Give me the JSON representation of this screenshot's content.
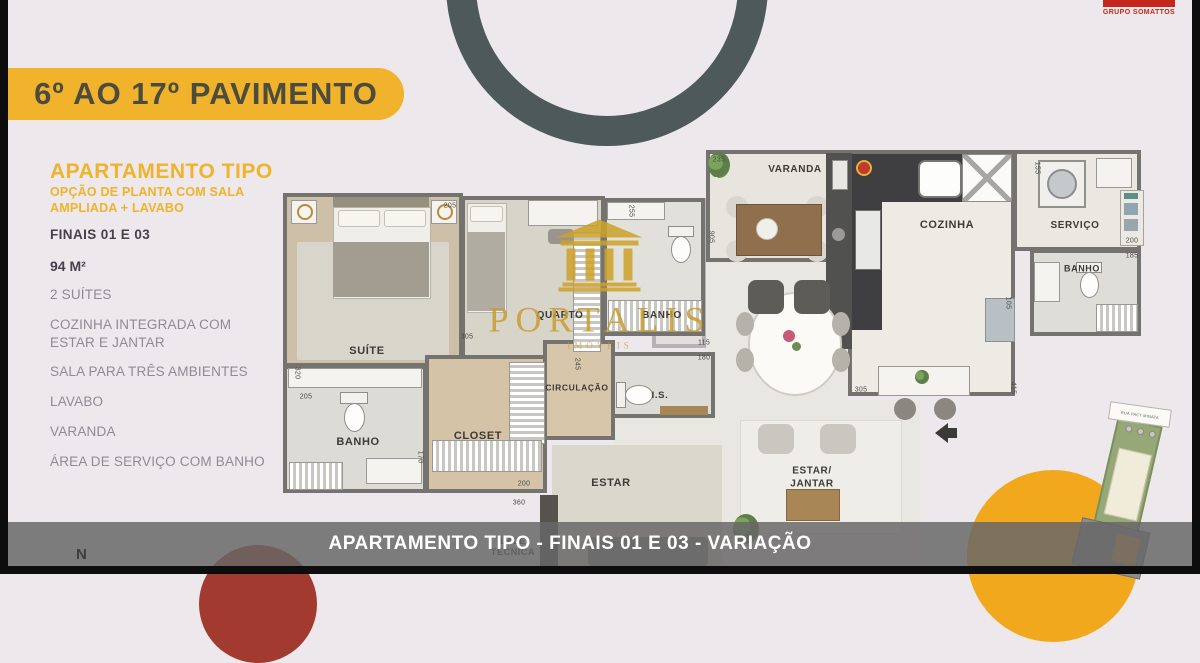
{
  "palette": {
    "accent_yellow": "#F0B32B",
    "slate_ring": "#4D5A59",
    "brand_red": "#C4281C",
    "circle_red": "#A23A2F",
    "circle_yellow": "#F2A81D",
    "gold": "#C99C2E"
  },
  "banner": {
    "title": "6º AO 17º PAVIMENTO"
  },
  "brand_top": {
    "name": "GRUPO SOMATTOS"
  },
  "sidebar": {
    "title": "APARTAMENTO TIPO",
    "subtitle": "OPÇÃO DE PLANTA COM SALA\nAMPLIADA + LAVABO",
    "finais": "FINAIS 01 E 03",
    "area": "94 M²",
    "features": [
      "2 SUÍTES",
      "COZINHA INTEGRADA COM ESTAR E JANTAR",
      "SALA PARA TRÊS AMBIENTES",
      "LAVABO",
      "VARANDA",
      "ÁREA DE SERVIÇO COM BANHO"
    ]
  },
  "watermark": {
    "name": "PORTALIS",
    "tagline": "IMÓVEIS"
  },
  "floorplan": {
    "rooms": [
      {
        "t": "VARANDA",
        "x": 795,
        "y": 170,
        "fs": 10
      },
      {
        "t": "COZINHA",
        "x": 947,
        "y": 226,
        "fs": 11
      },
      {
        "t": "SERVIÇO",
        "x": 1075,
        "y": 226,
        "fs": 10
      },
      {
        "t": "BANHO",
        "x": 1082,
        "y": 269,
        "fs": 9
      },
      {
        "t": "SUÍTE",
        "x": 367,
        "y": 352,
        "fs": 11
      },
      {
        "t": "QUARTO",
        "x": 560,
        "y": 316,
        "fs": 10
      },
      {
        "t": "BANHO",
        "x": 662,
        "y": 316,
        "fs": 10
      },
      {
        "t": "CIRCULAÇÃO",
        "x": 577,
        "y": 388,
        "fs": 8.5
      },
      {
        "t": "I.S.",
        "x": 660,
        "y": 396,
        "fs": 9.5
      },
      {
        "t": "BANHO",
        "x": 358,
        "y": 443,
        "fs": 11
      },
      {
        "t": "CLOSET",
        "x": 478,
        "y": 437,
        "fs": 11
      },
      {
        "t": "ESTAR",
        "x": 611,
        "y": 484,
        "fs": 11
      },
      {
        "t": "ESTAR/\nJANTAR",
        "x": 812,
        "y": 478,
        "fs": 10
      },
      {
        "t": "LAJE\nTÉCNICA",
        "x": 513,
        "y": 547,
        "fs": 9
      }
    ],
    "dimensions": [
      {
        "t": "235",
        "x": 719,
        "y": 160
      },
      {
        "t": "905",
        "x": 711,
        "y": 237,
        "rot": 90
      },
      {
        "t": "155",
        "x": 1037,
        "y": 168,
        "rot": 90
      },
      {
        "t": "200",
        "x": 1132,
        "y": 241
      },
      {
        "t": "185",
        "x": 1132,
        "y": 256
      },
      {
        "t": "105",
        "x": 1008,
        "y": 303,
        "rot": 90
      },
      {
        "t": "205",
        "x": 450,
        "y": 206
      },
      {
        "t": "255",
        "x": 631,
        "y": 211,
        "rot": 90
      },
      {
        "t": "305",
        "x": 467,
        "y": 337
      },
      {
        "t": "245",
        "x": 577,
        "y": 364,
        "rot": 90
      },
      {
        "t": "320",
        "x": 297,
        "y": 373,
        "rot": 90
      },
      {
        "t": "205",
        "x": 306,
        "y": 397
      },
      {
        "t": "170",
        "x": 420,
        "y": 457,
        "rot": 90
      },
      {
        "t": "200",
        "x": 524,
        "y": 484
      },
      {
        "t": "360",
        "x": 519,
        "y": 503
      },
      {
        "t": "115",
        "x": 704,
        "y": 343
      },
      {
        "t": "180",
        "x": 704,
        "y": 358
      },
      {
        "t": "305",
        "x": 861,
        "y": 390
      },
      {
        "t": "415",
        "x": 1013,
        "y": 388,
        "rot": 90
      }
    ]
  },
  "bottom_bar": {
    "caption": "APARTAMENTO TIPO - FINAIS 01 E 03 - VARIAÇÃO"
  },
  "compass": {
    "label": "N"
  },
  "minimap": {
    "street": "RUA PACT MINATA"
  }
}
